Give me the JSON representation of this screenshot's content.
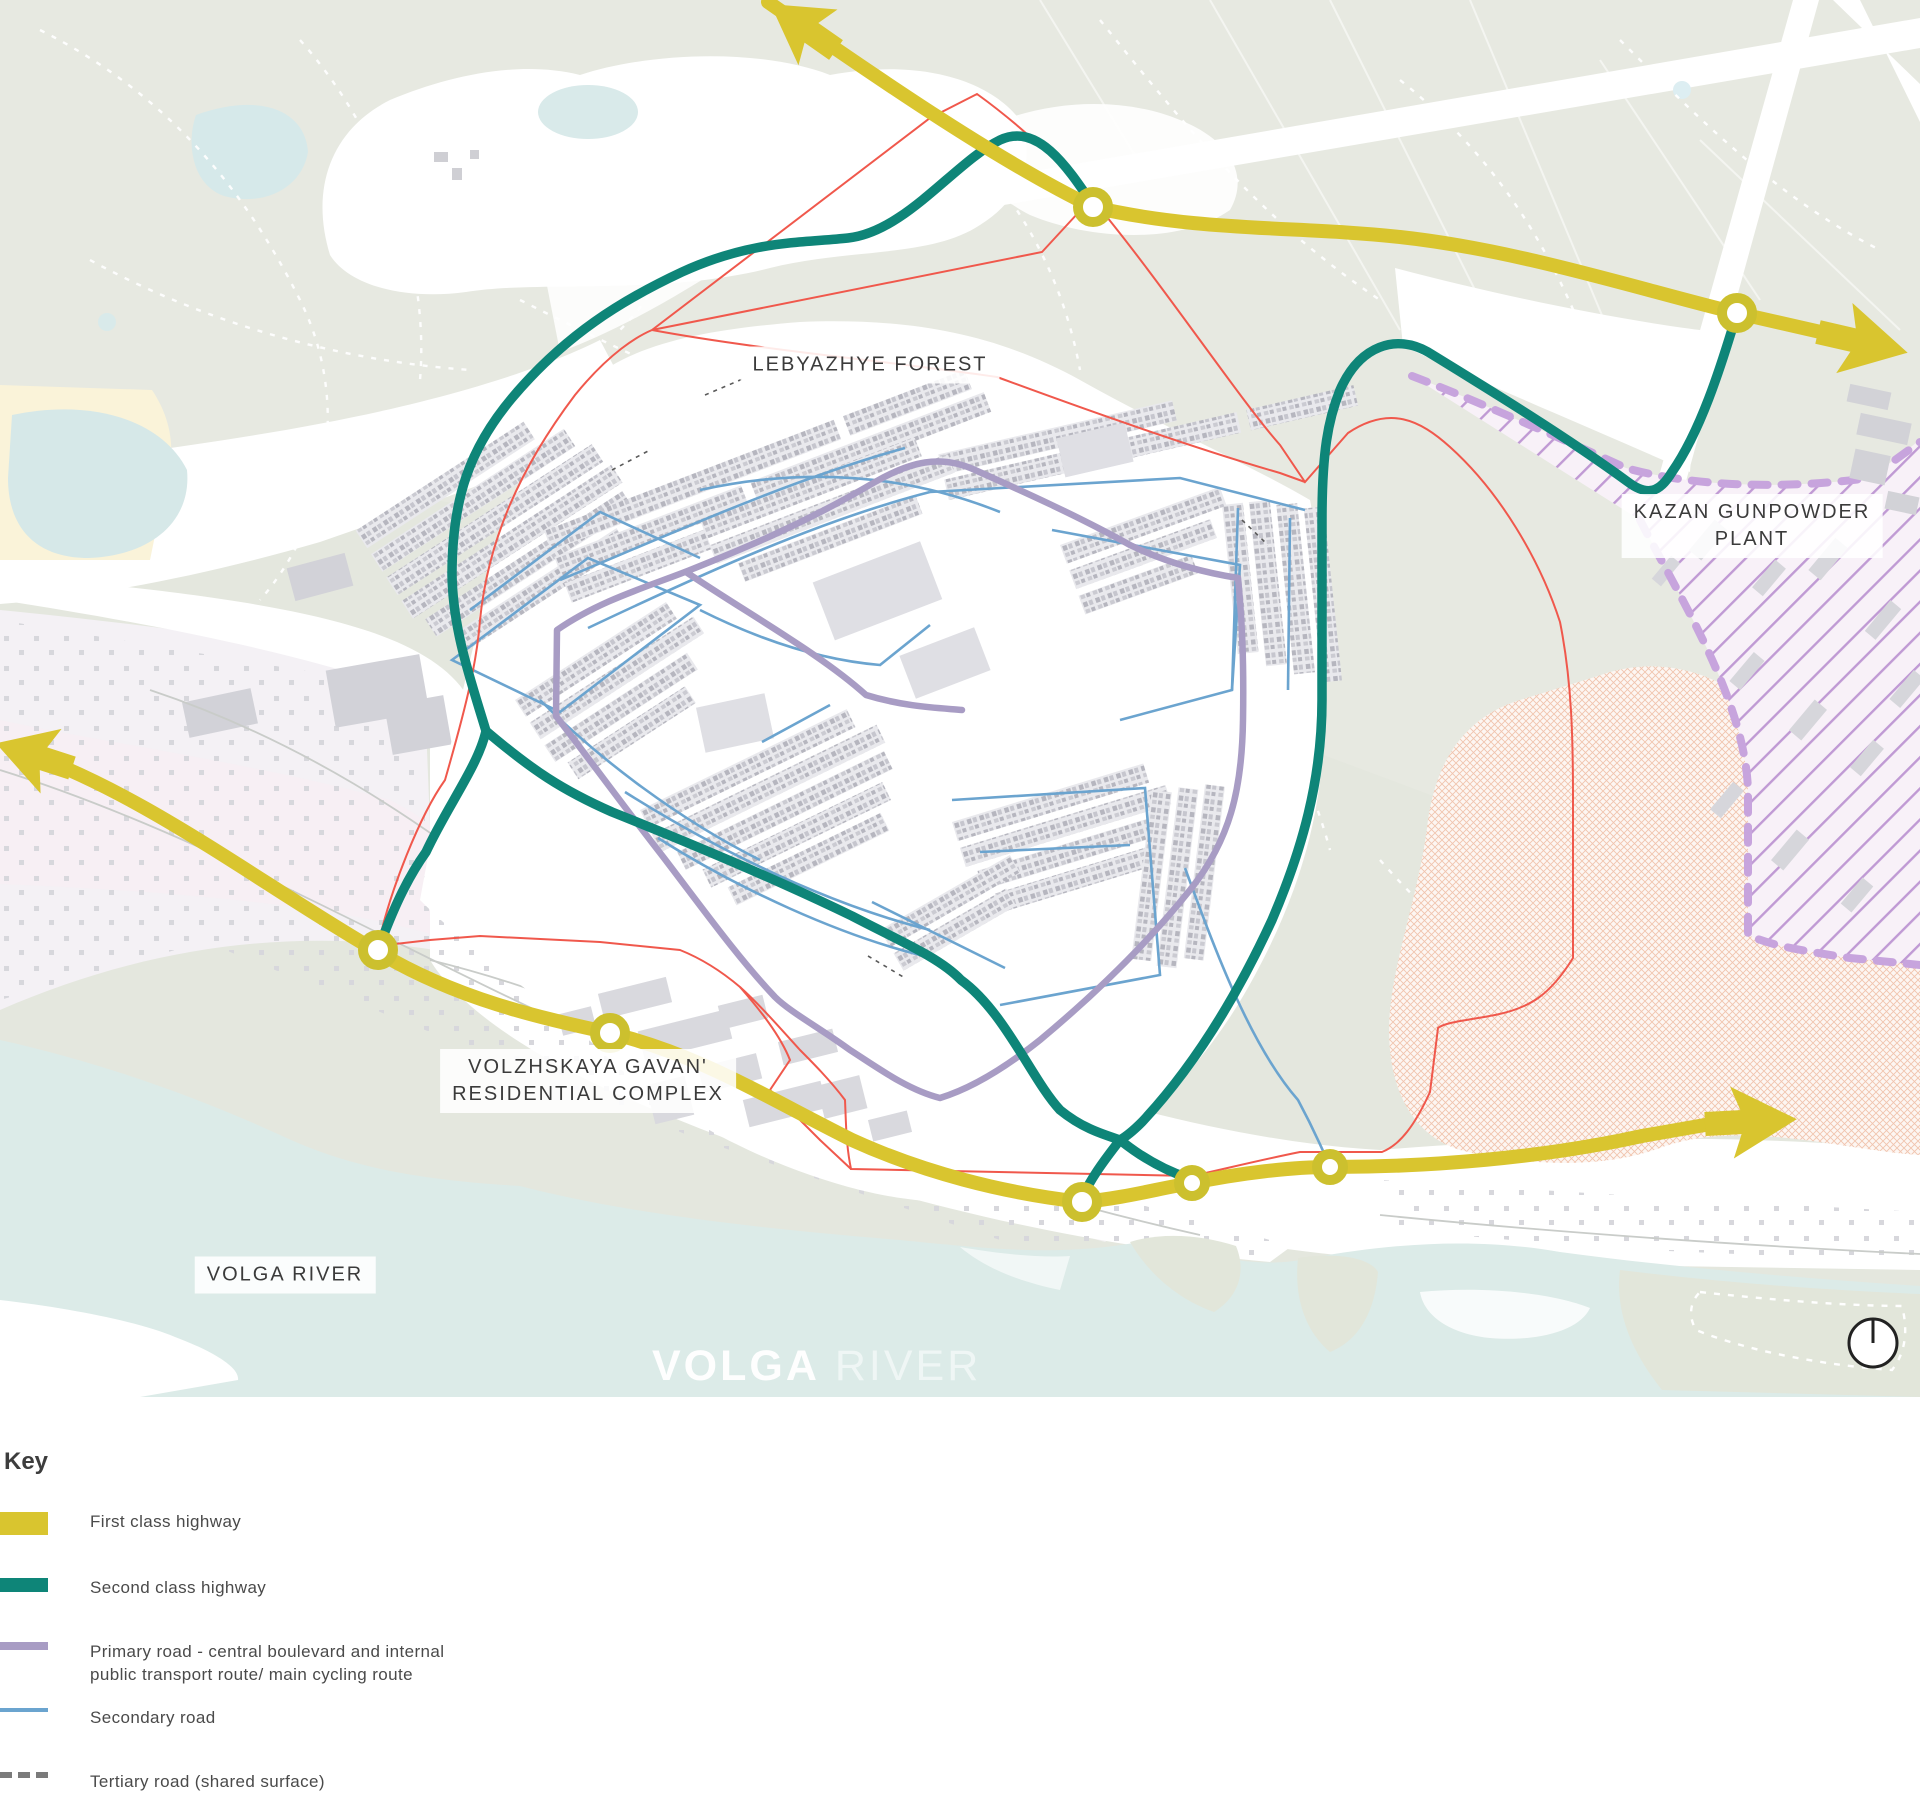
{
  "map": {
    "labels": {
      "forest": "LEBYAZHYE FOREST",
      "plant_line1": "KAZAN GUNPOWDER",
      "plant_line2": "PLANT",
      "complex_line1": "VOLZHSKAYA GAVAN'",
      "complex_line2": "RESIDENTIAL COMPLEX",
      "river": "VOLGA RIVER",
      "watermark_bold": "VOLGA",
      "watermark_light": " RIVER"
    },
    "icons": {
      "north_indicator": "circle with north line"
    }
  },
  "legend": {
    "title": "Key",
    "items": [
      {
        "label": "First class highway",
        "color": "#d9c52f",
        "style": "thick solid"
      },
      {
        "label": "Second class highway",
        "color": "#0e8578",
        "style": "solid"
      },
      {
        "label": "Primary road - central boulevard and internal public transport route/ main cycling route",
        "label_line1": "Primary road - central boulevard and internal",
        "label_line2": "public transport route/ main cycling route",
        "color": "#a89cc4",
        "style": "solid"
      },
      {
        "label": "Secondary road",
        "color": "#6ba4cf",
        "style": "thin solid"
      },
      {
        "label": "Tertiary road (shared surface)",
        "color": "#7b7b7b",
        "style": "dashed"
      }
    ]
  },
  "colors": {
    "forest": "#e7e9e1",
    "water": "#dcebe8",
    "site_boundary_red": "#f0584c",
    "gunpowder_hatch": "#bf99d4",
    "gunpowder_border": "#c7a4dd",
    "settlement_hatch": "#f0c4ae",
    "first_class_highway": "#d9c52f",
    "second_class_highway": "#0e8578",
    "primary_road": "#a89cc4",
    "secondary_road": "#6ba4cf"
  }
}
